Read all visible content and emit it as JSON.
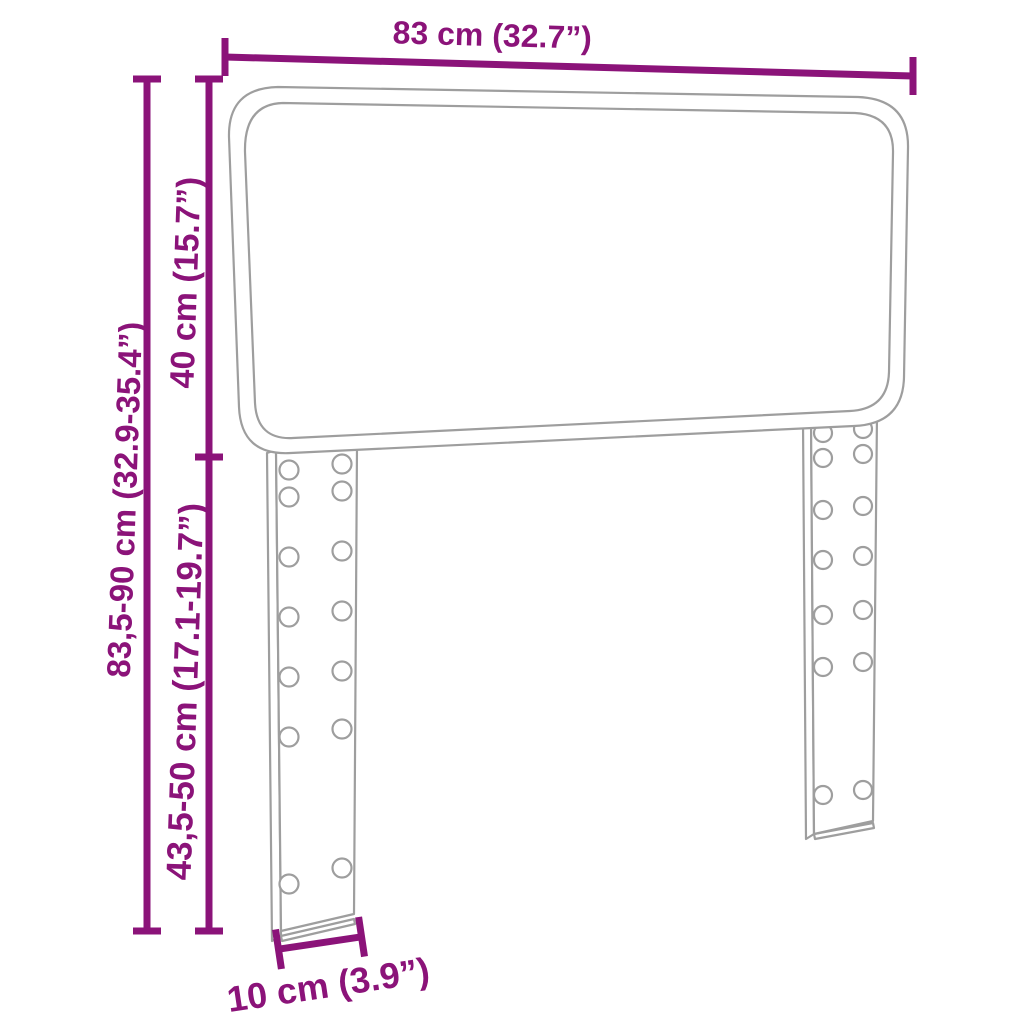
{
  "diagram": {
    "kind": "product-dimension-diagram",
    "product": "headboard with two slotted mounting legs",
    "labels": {
      "width": "83 cm (32.7”)",
      "total_height": "83,5-90 cm (32.9-35.4”)",
      "panel_height": "40 cm (15.7”)",
      "leg_height": "43,5-50 cm (17.1-19.7”)",
      "leg_width": "10 cm (3.9”)"
    }
  },
  "colors": {
    "accent": "#8B1379",
    "outline": "#9E9E9E",
    "background": "#FFFFFF"
  }
}
